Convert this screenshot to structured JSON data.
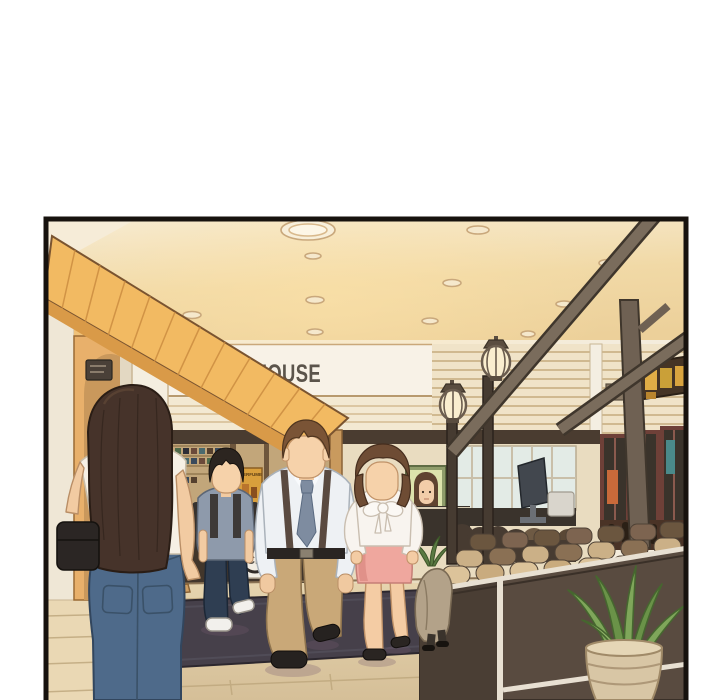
{
  "meta": {
    "type": "webtoon-comic-panel",
    "scene": "Indoor mall corridor: dry-cleaner storefront with pedestrians, wooden kiosk with lantern lamps and potted plant"
  },
  "signs": {
    "clean_house": "CLEAN HOUSE",
    "ch_logo": "CH",
    "perfume_poster": "PERFUME"
  },
  "palette": {
    "panel_border": "#17120e",
    "ceiling_warm": "#f1d9a6",
    "canopy_orange": "#f2ba62",
    "fascia_white": "#f8f2e7",
    "sign_text": "#5b544b",
    "wood_beam": "#7a6c5c",
    "kiosk_counter": "#594b40",
    "floor_tile": "#ddc9a2",
    "entrance_mat": "#46404a",
    "jeans_blue": "#4e6a8a",
    "skirt_pink": "#efa79e",
    "khaki_pants": "#c9a878",
    "polo_blue": "#8e9aab",
    "plant_green": "#7fa65a",
    "lantern_glow": "#faeecf"
  }
}
